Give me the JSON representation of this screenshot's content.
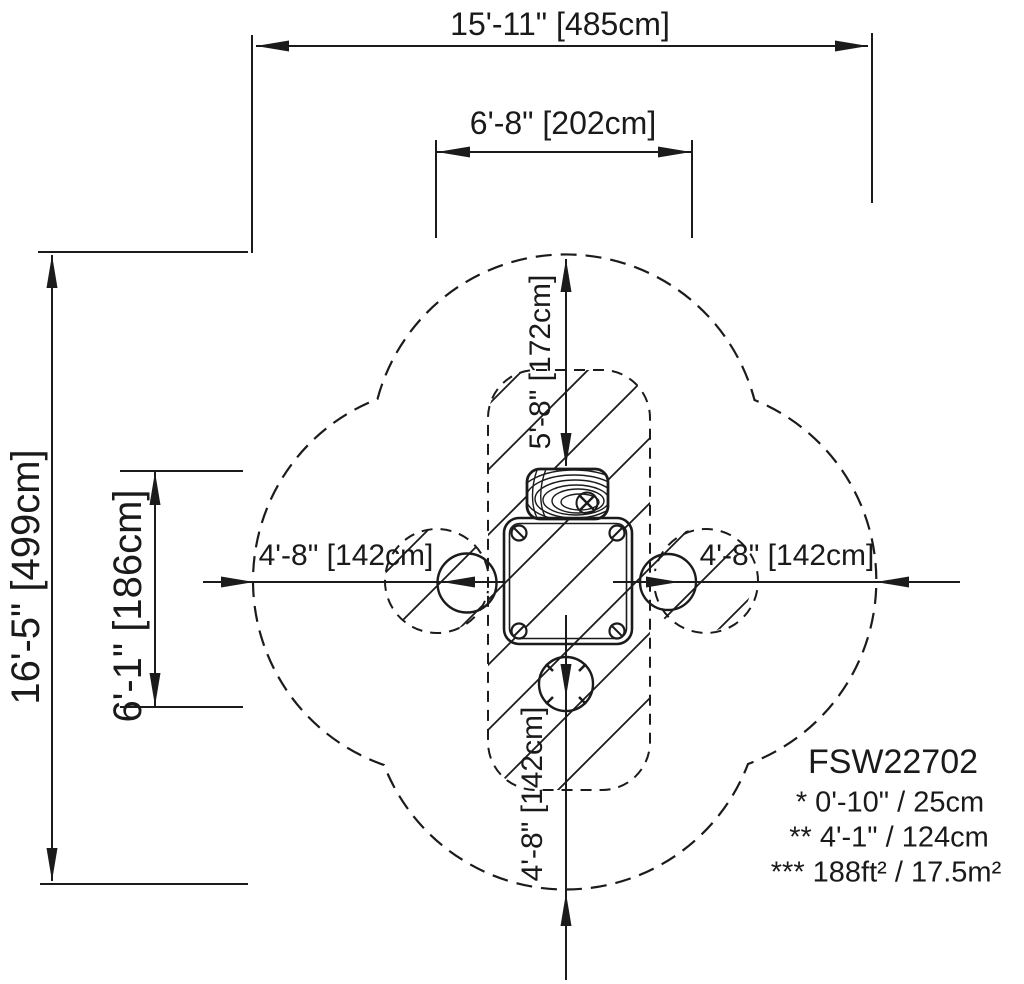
{
  "drawing": {
    "dimensions": {
      "overall_width": "15'-11\" [485cm]",
      "inner_width": "6'-8\" [202cm]",
      "overall_height": "16'-5\" [499cm]",
      "inner_height": "6'-1\" [186cm]",
      "top_clearance": "5'-8\" [172cm]",
      "left_clearance": "4'-8\" [142cm]",
      "right_clearance": "4'-8\" [142cm]",
      "bottom_clearance": "4'-8\" [142cm]"
    },
    "legend": {
      "model": "FSW22702",
      "fall_height_note": "* 0'-10\" / 25cm",
      "critical_height_note": "** 4'-1\" / 124cm",
      "area_note": "*** 188ft² / 17.5m²"
    },
    "colors": {
      "line": "#1b1b1b",
      "background": "#ffffff"
    }
  }
}
